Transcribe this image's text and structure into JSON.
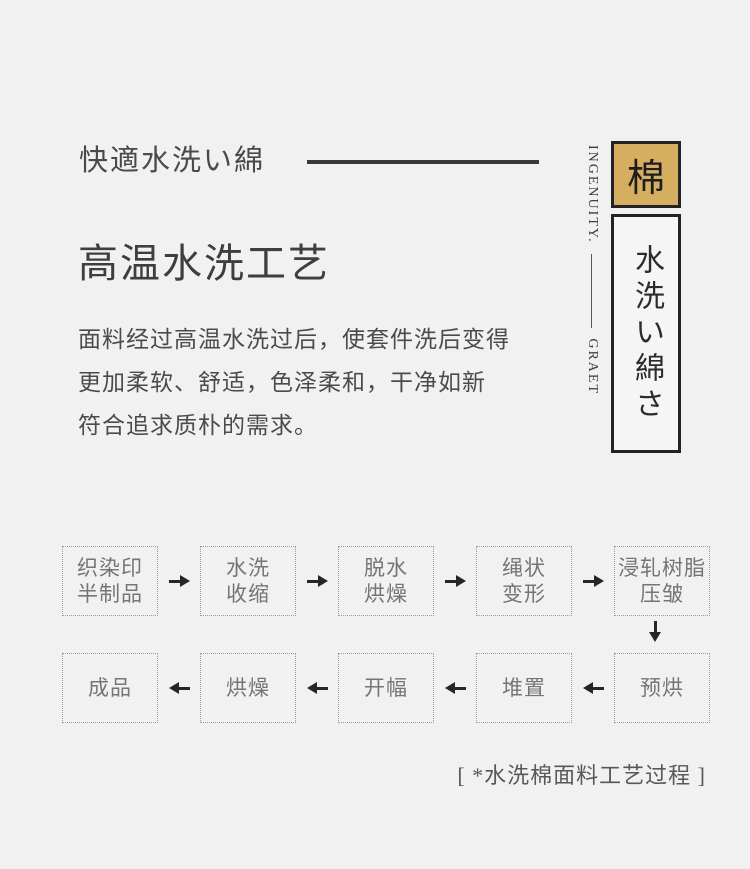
{
  "page": {
    "background": "#f1f1f2",
    "accent_gold": "#d5ae5f",
    "border_dark": "#232327"
  },
  "header": {
    "jp_label": "快適水洗い綿",
    "side_en_top": "INGENUITY.",
    "side_en_bottom": "GRAET",
    "gold_char": "棉",
    "vertical_label": "水洗い綿さ"
  },
  "main": {
    "title": "高温水洗工艺",
    "paragraph_lines": [
      "面料经过高温水洗过后，使套件洗后变得",
      "更加柔软、舒适，色泽柔和，干净如新",
      "符合追求质朴的需求。"
    ]
  },
  "flow": {
    "top_row": [
      {
        "line1": "织染印",
        "line2": "半制品"
      },
      {
        "line1": "水洗",
        "line2": "收缩"
      },
      {
        "line1": "脱水",
        "line2": "烘燥"
      },
      {
        "line1": "绳状",
        "line2": "变形"
      },
      {
        "line1": "浸轧树脂",
        "line2": "压皱"
      }
    ],
    "bottom_row": [
      {
        "label": "成品"
      },
      {
        "label": "烘燥"
      },
      {
        "label": "开幅"
      },
      {
        "label": "堆置"
      },
      {
        "label": "预烘"
      }
    ],
    "caption": "[ *水洗棉面料工艺过程 ]"
  }
}
